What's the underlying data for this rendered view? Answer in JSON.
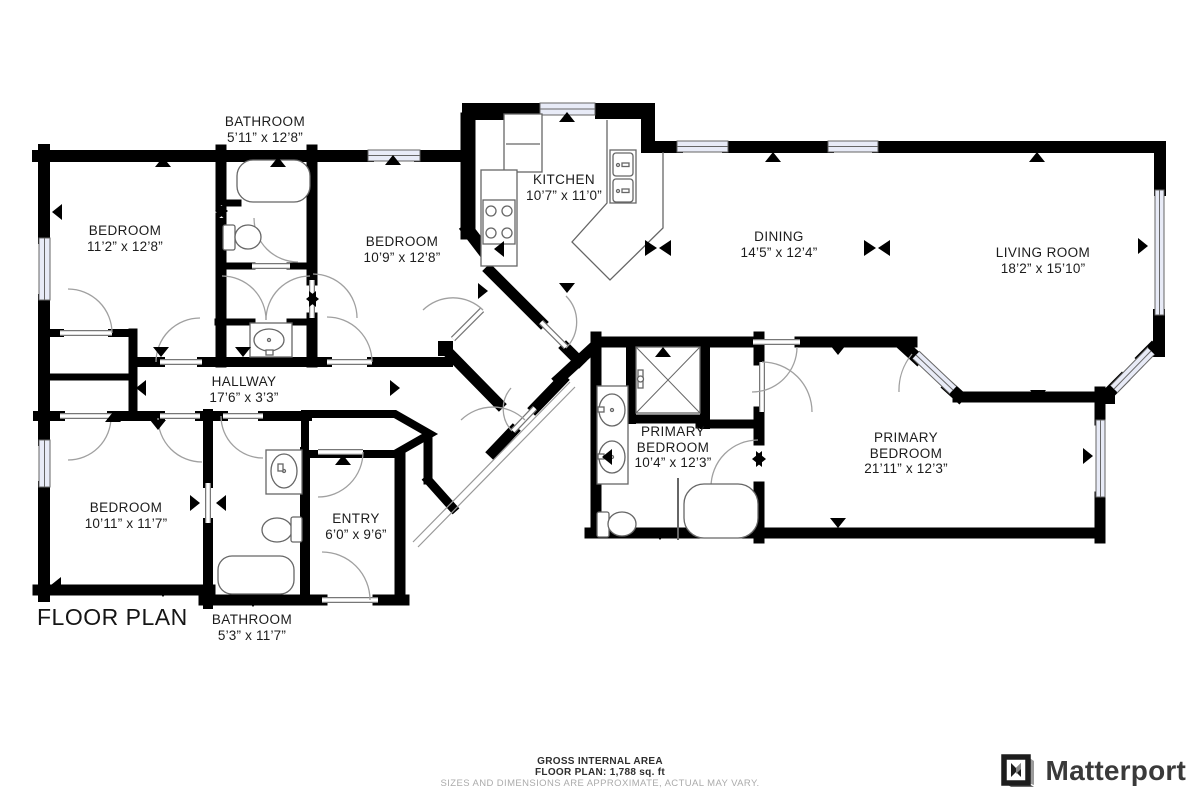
{
  "title": "FLOOR PLAN",
  "rooms": {
    "bathroom_top": {
      "name": "BATHROOM",
      "dims": "5’11” x 12’8”"
    },
    "bedroom_1": {
      "name": "BEDROOM",
      "dims": "11’2” x 12’8”"
    },
    "bedroom_2": {
      "name": "BEDROOM",
      "dims": "10’9” x 12’8”"
    },
    "kitchen": {
      "name": "KITCHEN",
      "dims": "10’7” x 11’0”"
    },
    "dining": {
      "name": "DINING",
      "dims": "14’5” x 12’4”"
    },
    "living_room": {
      "name": "LIVING ROOM",
      "dims": "18’2” x 15’10”"
    },
    "hallway": {
      "name": "HALLWAY",
      "dims": "17’6” x 3’3”"
    },
    "bedroom_3": {
      "name": "BEDROOM",
      "dims": "10’11” x 11’7”"
    },
    "entry": {
      "name": "ENTRY",
      "dims": "6’0” x 9’6”"
    },
    "bathroom_bottom": {
      "name": "BATHROOM",
      "dims": "5’3” x 11’7”"
    },
    "primary_bedroom_small": {
      "name_line1": "PRIMARY",
      "name_line2": "BEDROOM",
      "dims": "10’4” x 12’3”"
    },
    "primary_bedroom_large": {
      "name_line1": "PRIMARY",
      "name_line2": "BEDROOM",
      "dims": "21’11” x 12’3”"
    }
  },
  "footer": {
    "area_label": "GROSS INTERNAL AREA",
    "area_value": "FLOOR PLAN: 1,788 sq. ft",
    "disclaimer": "SIZES AND DIMENSIONS ARE APPROXIMATE, ACTUAL MAY VARY."
  },
  "brand": {
    "name": "Matterport"
  },
  "colors": {
    "wall": "#000000",
    "window_fill": "#e8ebf7",
    "door_arc": "#a0a0a0",
    "fixture_stroke": "#666666",
    "text": "#1c1c1c",
    "disclaimer_text": "#ababab",
    "logo_text": "#3a3a3a"
  }
}
